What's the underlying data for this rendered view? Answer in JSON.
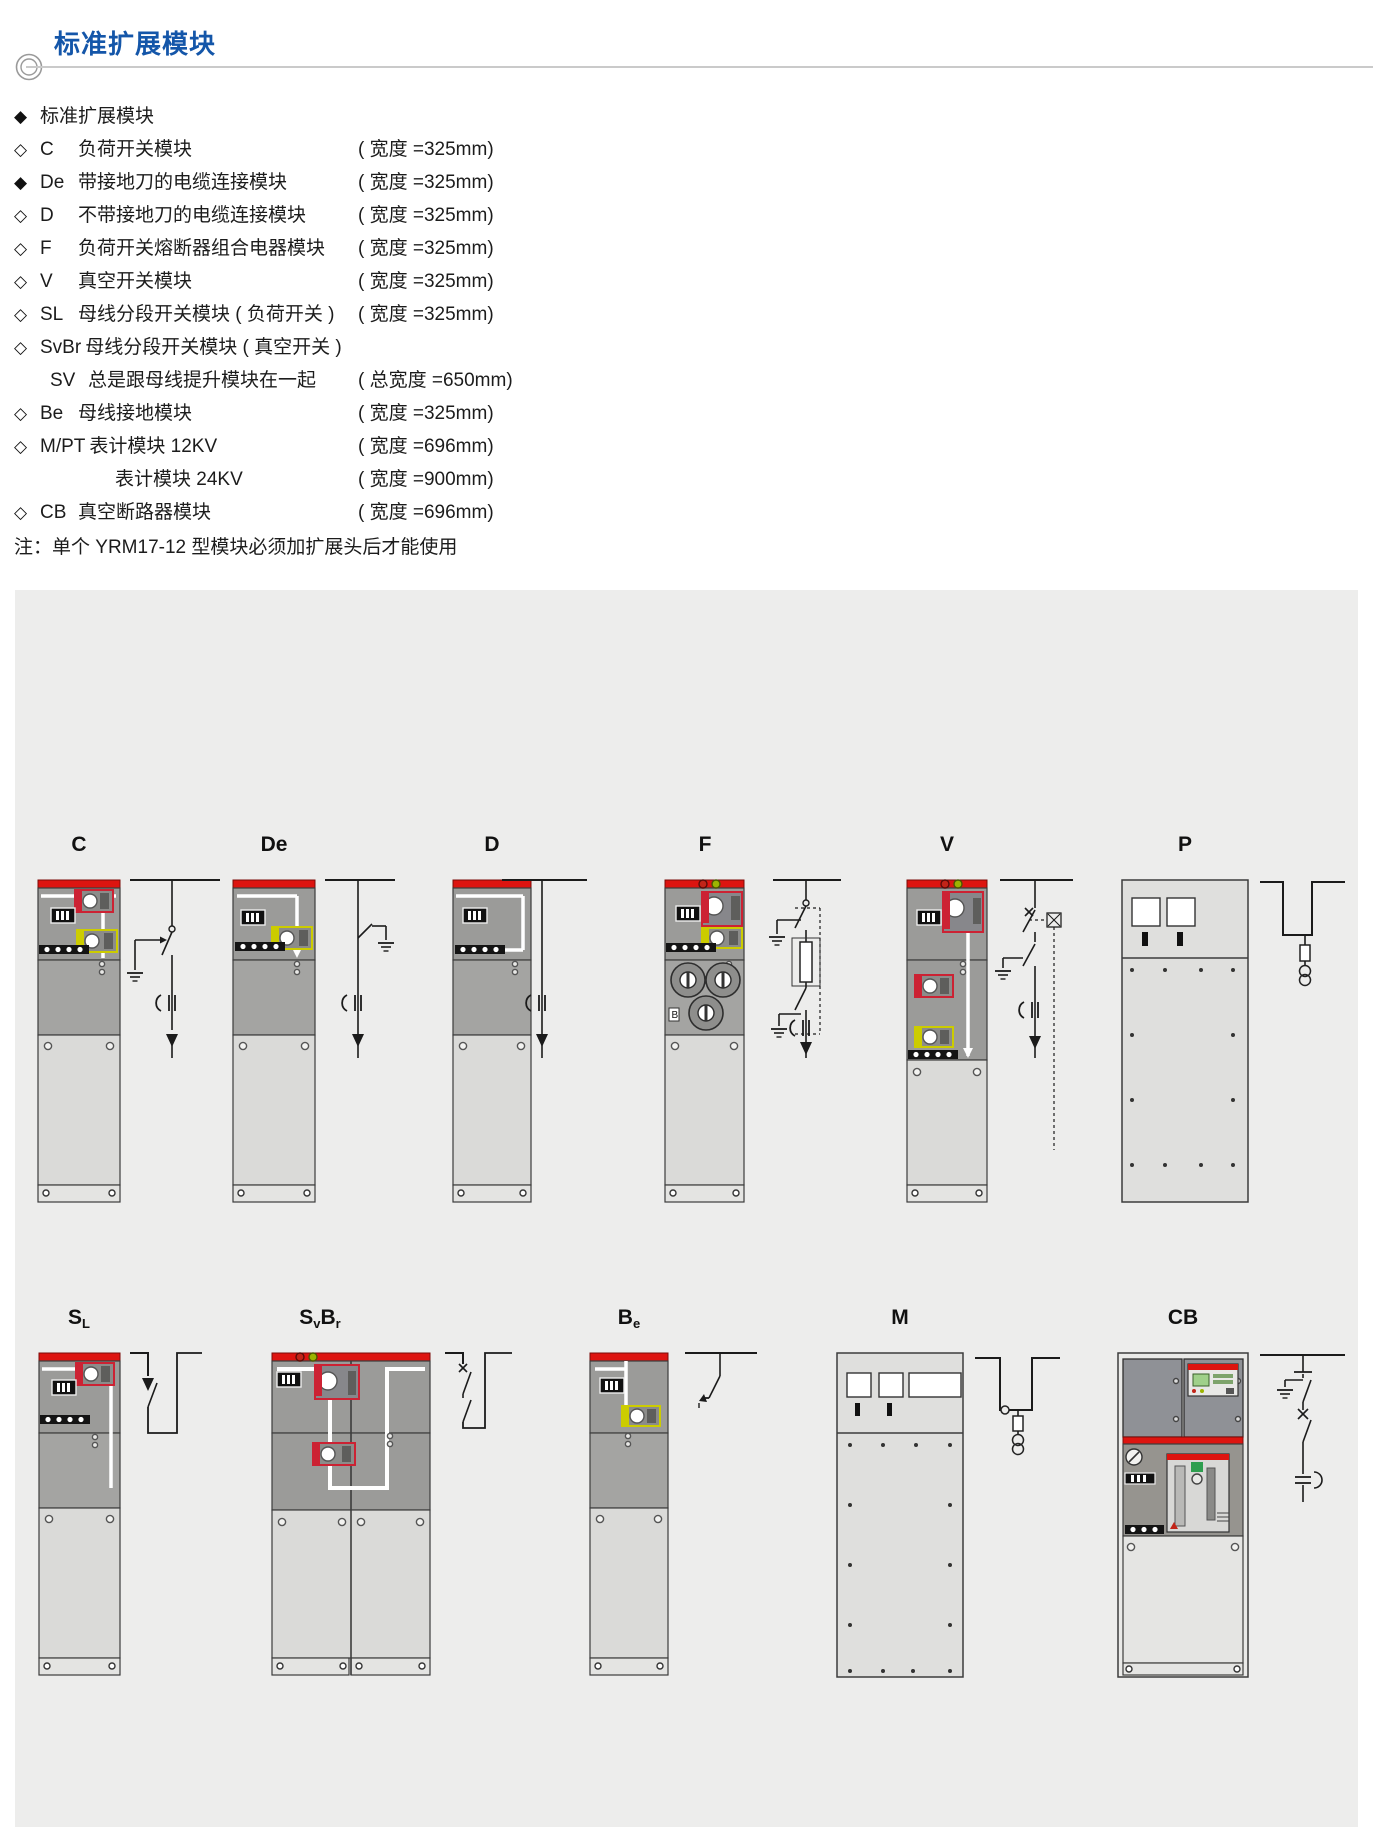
{
  "page": {
    "title": "标准扩展模块"
  },
  "colors": {
    "accent_blue": "#1456A9",
    "cabinet_red": "#DD1410",
    "panel_bg": "#EDEDEC",
    "cabinet_gray": "#9B9B99",
    "cabinet_light": "#DADAD8"
  },
  "intro": {
    "header": {
      "bullet": "filled",
      "text": "标准扩展模块"
    },
    "items": [
      {
        "bullet": "hollow",
        "code": "C",
        "desc": "负荷开关模块",
        "width": "( 宽度 =325mm)",
        "indent": 0
      },
      {
        "bullet": "filled",
        "code": "De",
        "desc": "带接地刀的电缆连接模块",
        "width": "( 宽度 =325mm)",
        "indent": 0
      },
      {
        "bullet": "hollow",
        "code": "D",
        "desc": "不带接地刀的电缆连接模块",
        "width": "( 宽度 =325mm)",
        "indent": 0
      },
      {
        "bullet": "hollow",
        "code": "F",
        "desc": "负荷开关熔断器组合电器模块",
        "width": "( 宽度 =325mm)",
        "indent": 0
      },
      {
        "bullet": "hollow",
        "code": "V",
        "desc": "真空开关模块",
        "width": "( 宽度 =325mm)",
        "indent": 0
      },
      {
        "bullet": "hollow",
        "code": "SL",
        "desc": "母线分段开关模块 ( 负荷开关 )",
        "width": "( 宽度 =325mm)",
        "indent": 0
      },
      {
        "bullet": "hollow",
        "code": "SvBr",
        "desc": "母线分段开关模块 ( 真空开关 )",
        "width": "",
        "indent": 0
      },
      {
        "bullet": "none",
        "code": "SV",
        "desc": "总是跟母线提升模块在一起",
        "width": "( 总宽度 =650mm)",
        "indent": 10
      },
      {
        "bullet": "hollow",
        "code": "Be",
        "desc": "母线接地模块",
        "width": "( 宽度 =325mm)",
        "indent": 0
      },
      {
        "bullet": "hollow",
        "code": "M/PT",
        "desc": "表计模块 12KV",
        "width": "( 宽度 =696mm)",
        "indent": 0
      },
      {
        "bullet": "none",
        "code": "",
        "desc": "表计模块 24KV",
        "width": "( 宽度 =900mm)",
        "indent": 37
      },
      {
        "bullet": "hollow",
        "code": "CB",
        "desc": "真空断路器模块",
        "width": "( 宽度 =696mm)",
        "indent": 0
      }
    ],
    "note": "注：单个 YRM17-12 型模块必须加扩展头后才能使用"
  },
  "panel": {
    "modules": [
      {
        "id": "C",
        "label": [
          {
            "t": "C"
          }
        ]
      },
      {
        "id": "De",
        "label": [
          {
            "t": "De"
          }
        ]
      },
      {
        "id": "D",
        "label": [
          {
            "t": "D"
          }
        ]
      },
      {
        "id": "F",
        "label": [
          {
            "t": "F"
          }
        ],
        "badge": "B"
      },
      {
        "id": "V",
        "label": [
          {
            "t": "V"
          }
        ]
      },
      {
        "id": "P",
        "label": [
          {
            "t": "P"
          }
        ]
      },
      {
        "id": "SL",
        "label": [
          {
            "t": "S"
          },
          {
            "t": "L",
            "sub": true
          }
        ]
      },
      {
        "id": "SvBr",
        "label": [
          {
            "t": "S"
          },
          {
            "t": "v",
            "sub": true
          },
          {
            "t": "B"
          },
          {
            "t": "r",
            "sub": true
          }
        ]
      },
      {
        "id": "Be",
        "label": [
          {
            "t": "B"
          },
          {
            "t": "e",
            "sub": true
          }
        ]
      },
      {
        "id": "M",
        "label": [
          {
            "t": "M"
          }
        ]
      },
      {
        "id": "CB",
        "label": [
          {
            "t": "CB"
          }
        ]
      }
    ]
  }
}
